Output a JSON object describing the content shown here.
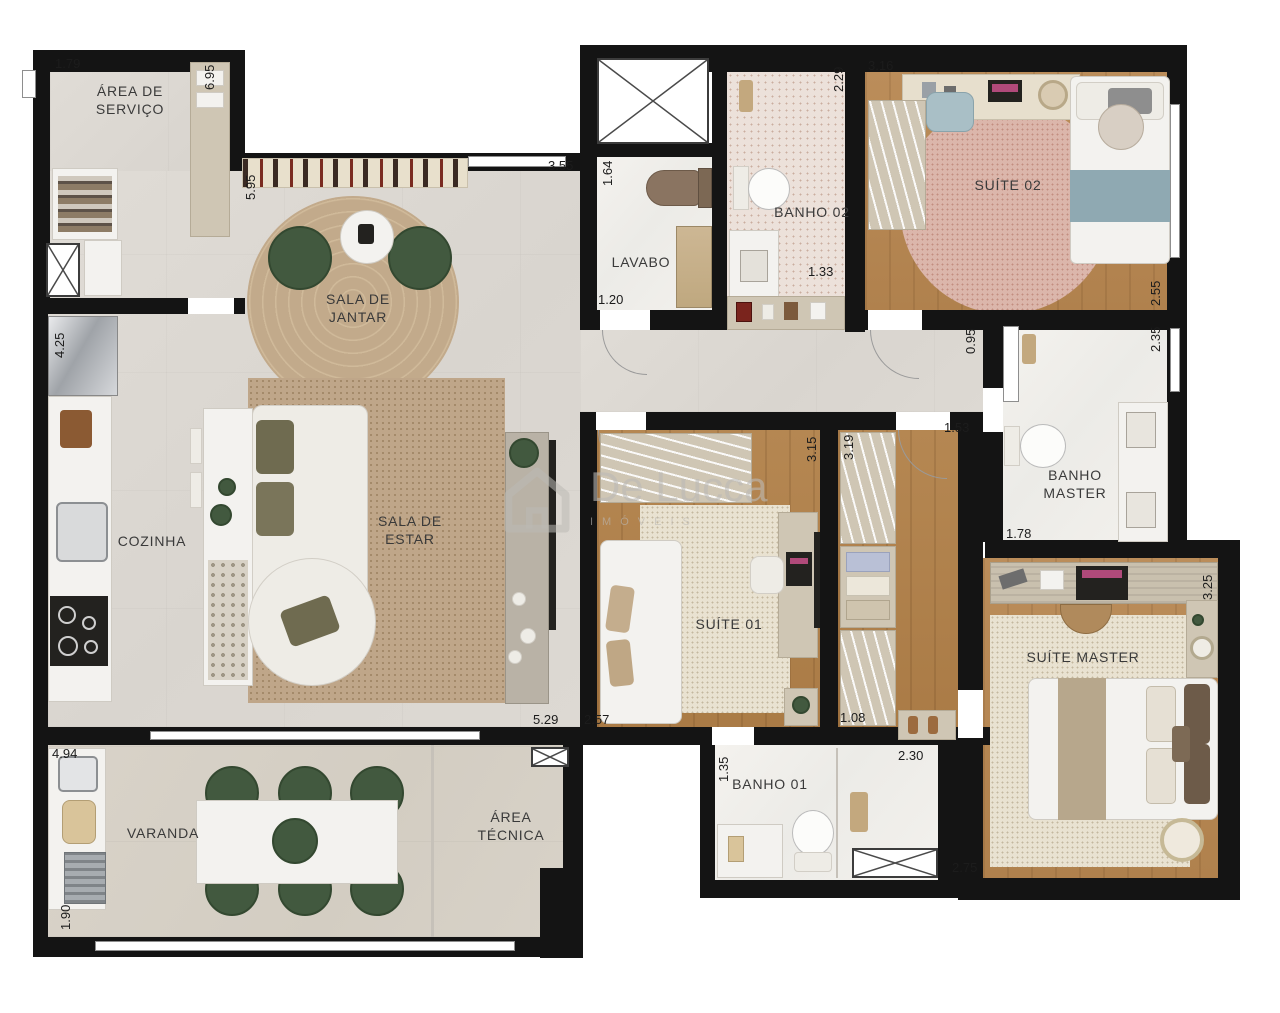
{
  "watermark": {
    "brand": "De Lucca",
    "subtitle": "IMÓVEIS"
  },
  "rooms": {
    "area_servico": {
      "label": "ÁREA DE\nSERVIÇO"
    },
    "sala_jantar": {
      "label": "SALA DE\nJANTAR"
    },
    "sala_estar": {
      "label": "SALA DE\nESTAR"
    },
    "cozinha": {
      "label": "COZINHA"
    },
    "lavabo": {
      "label": "LAVABO"
    },
    "banho02": {
      "label": "BANHO 02"
    },
    "suite02": {
      "label": "SUÍTE 02"
    },
    "banho_master": {
      "label": "BANHO\nMASTER"
    },
    "suite01": {
      "label": "SUÍTE 01"
    },
    "suite_master": {
      "label": "SUÍTE MASTER"
    },
    "banho01": {
      "label": "BANHO 01"
    },
    "varanda": {
      "label": "VARANDA"
    },
    "area_tecnica": {
      "label": "ÁREA\nTÉCNICA"
    }
  },
  "dims": {
    "servico_w": "1.79",
    "servico_h": "6.95",
    "jantar_h": "5.95",
    "sala_top_w": "3.55",
    "lavabo_h": "1.64",
    "lavabo_w": "1.20",
    "banho02_h": "2.29",
    "banho02_w": "1.33",
    "suite02_w": "3.16",
    "suite02_h": "2.55",
    "cozinha_h": "4.25",
    "hall_h": "0.95",
    "banho_master_h": "2.35",
    "banho_master_w": "1.78",
    "closet_w": "1.53",
    "closet_h": "3.19",
    "closet_w2": "1.08",
    "suite01_h": "3.15",
    "suite01_w": "2.57",
    "sala_w": "5.29",
    "suite_master_h": "3.25",
    "suite_master_w": "2.75",
    "banho01_h": "1.35",
    "banho01_w": "2.30",
    "varanda_w": "4.94",
    "varanda_h": "1.90"
  },
  "colors": {
    "wall": "#141414",
    "floor_tile": "#dcd8d2",
    "floor_wood": "#b0804e",
    "floor_marble": "#f2f0ec",
    "rug_tan": "#bfa689",
    "rug_pink": "#dbb6ab",
    "accent_green": "#42593f",
    "watermark_gray": "#bbb9b5"
  }
}
